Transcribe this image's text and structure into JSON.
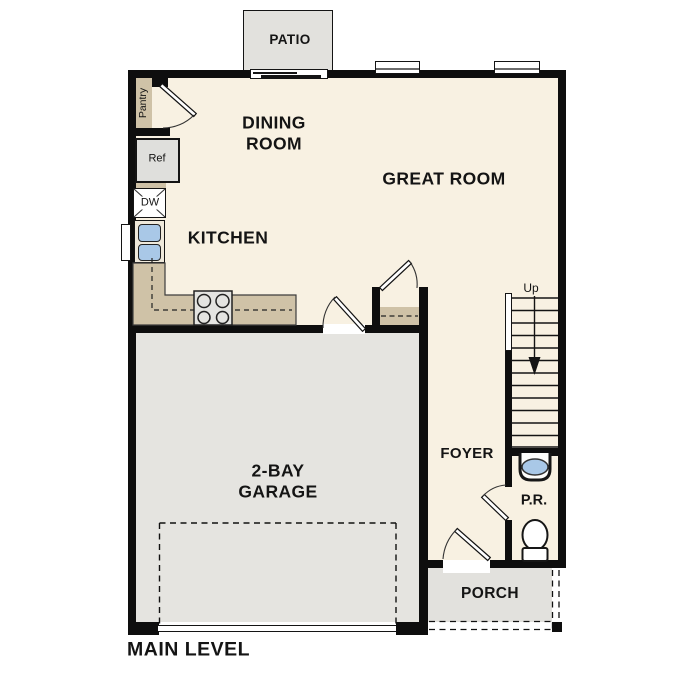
{
  "title": {
    "label": "MAIN LEVEL"
  },
  "rooms": {
    "patio": {
      "label": "PATIO"
    },
    "dining": {
      "label": "DINING ROOM"
    },
    "great": {
      "label": "GREAT ROOM"
    },
    "kitchen": {
      "label": "KITCHEN"
    },
    "garage": {
      "label": "2-BAY GARAGE"
    },
    "foyer": {
      "label": "FOYER"
    },
    "powder_room": {
      "label": "P.R."
    },
    "porch": {
      "label": "PORCH"
    }
  },
  "appliances": {
    "pantry": "Pantry",
    "refrigerator": "Ref",
    "dishwasher": "DW"
  },
  "annotations": {
    "stairs_direction": "Up"
  },
  "colors": {
    "floor": "#f8f1e2",
    "garage": "#e5e4e0",
    "outdoor": "#e2e1dd",
    "counter": "#cfc2a7",
    "fixture_blue": "#a9c8e7",
    "wall": "#0e0e0e"
  }
}
